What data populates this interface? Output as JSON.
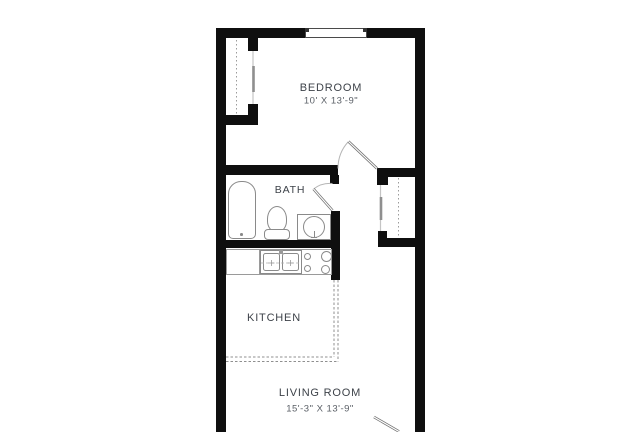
{
  "plan": {
    "title": "Studio / one-bedroom apartment floor plan",
    "wall_color": "#0f0f0f",
    "fixture_line_color": "#8a8a8a",
    "label_color": "#3d4249",
    "dim_color": "#5a5f66",
    "background": "#ffffff"
  },
  "rooms": {
    "bedroom": {
      "label": "BEDROOM",
      "dimensions": "10' X 13'-9\""
    },
    "bath": {
      "label": "BATH"
    },
    "kitchen": {
      "label": "KITCHEN"
    },
    "living_room": {
      "label": "LIVING ROOM",
      "dimensions": "15'-3\" X 13'-9\""
    }
  },
  "fixtures": [
    "window",
    "bedroom-closet-sliding-door",
    "hall-closet-sliding-door",
    "bedroom-door",
    "bath-door",
    "entry-door",
    "bathtub",
    "toilet",
    "vanity-sink",
    "kitchen-counter",
    "kitchen-double-sink",
    "stove-cooktop"
  ]
}
